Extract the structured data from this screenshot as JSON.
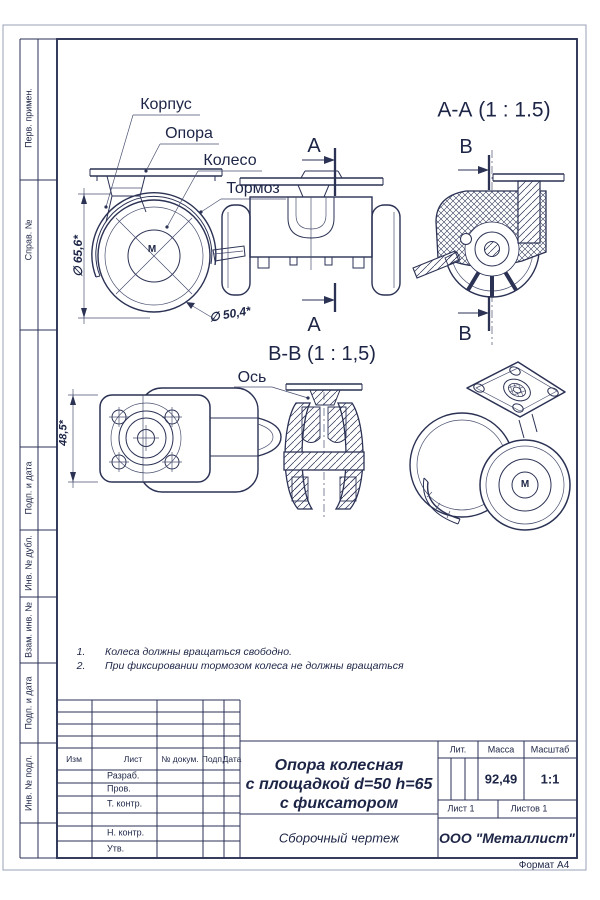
{
  "colors": {
    "line": "#2b3254",
    "thin_line": "#4a5170",
    "text": "#1d2546",
    "sheet_border": "#9aa0b5"
  },
  "margin_labels": {
    "perv_primen": "Перв. примен.",
    "sprav_no": "Справ. №",
    "podp_i_data_1": "Подп. и дата",
    "inv_no_dubl": "Инв. № дубл.",
    "vzam_inv_no": "Взам. инв. №",
    "podp_i_data_2": "Подп. и дата",
    "inv_no_podl": "Инв. № подл."
  },
  "views": {
    "callouts": {
      "korpus": "Корпус",
      "opora": "Опора",
      "koleso": "Колесо",
      "tormoz": "Тормоз",
      "os": "Ось"
    },
    "sections": {
      "aa_title": "А-А (1 : 1.5)",
      "bb_title": "В-В (1 : 1,5)",
      "a_mark": "А",
      "b_mark": "В"
    },
    "dims": {
      "d_outer": "∅ 65,6*",
      "d_wheel": "∅ 50,4*",
      "height": "48,5*"
    },
    "wheel_mark": "М"
  },
  "notes": {
    "items": [
      {
        "num": "1.",
        "text": "Колеса должны вращаться свободно."
      },
      {
        "num": "2.",
        "text": "При фиксировании тормозом колеса не должны вращаться"
      }
    ]
  },
  "title_block": {
    "rev_cols": {
      "izm": "Изм",
      "list": "Лист",
      "dokum": "№ докум.",
      "podp": "Подп.",
      "data": "Дата"
    },
    "roles": {
      "razrab": "Разраб.",
      "prov": "Пров.",
      "t_kontr": "Т. контр.",
      "n_kontr": "Н. контр.",
      "utv": "Утв."
    },
    "lit_label": "Лит.",
    "massa_label": "Масса",
    "masshtab_label": "Масштаб",
    "massa_value": "92,49",
    "scale_value": "1:1",
    "sheet_label": "Лист 1",
    "sheets_label": "Листов 1",
    "title_lines": [
      "Опора колесная",
      "с площадкой d=50 h=65",
      "с фиксатором"
    ],
    "doc_type": "Сборочный чертеж",
    "company": "ООО \"Металлист\"",
    "format_note": "Формат А4"
  }
}
